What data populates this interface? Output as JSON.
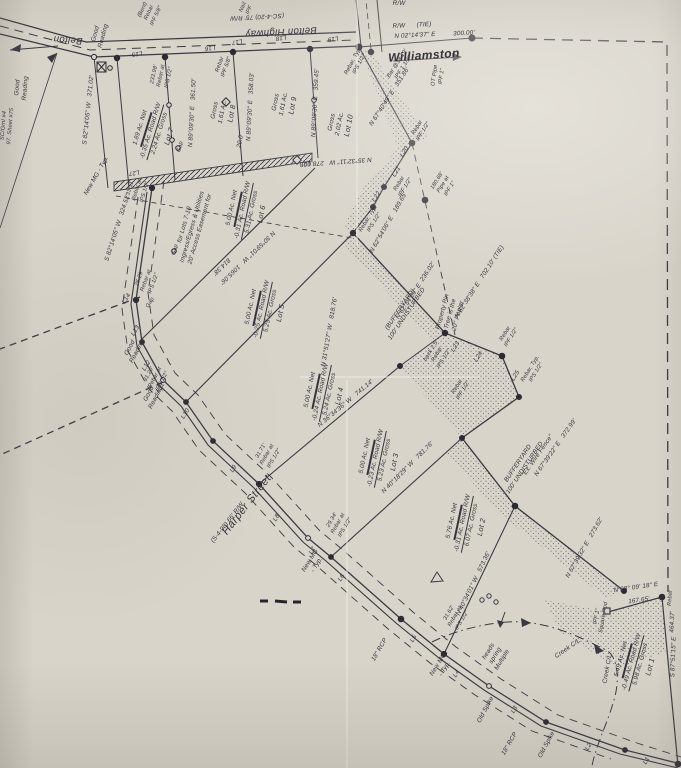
{
  "roads": {
    "belton": "Belton",
    "belton_highway": "Belton Highway",
    "belton_rw": "(SC-4-20) 75' R/W",
    "harper": "Harper Street",
    "harper_rw": "(S-4-98) 66' R/W",
    "williamston": "Williamston",
    "rw_tie": "R/W      (TIE)",
    "rw": "R/W"
  },
  "lots": [
    {
      "name": "Lot 1",
      "gross": "5.98 Ac. Gross",
      "road_rw": "-0.49 Ac. Road R/W",
      "net": "5.49 Ac. Net"
    },
    {
      "name": "Lot 2",
      "gross": "6.07 Ac. Gross",
      "road_rw": "-0.31 Ac. Road R/W",
      "net": "5.76 Ac. Net"
    },
    {
      "name": "Lot 3",
      "gross": "5.23 Ac. Gross",
      "road_rw": "-0.23 Ac. Road R/W",
      "net": "5.00 Ac. Net"
    },
    {
      "name": "Lot 4",
      "gross": "5.24 Ac. Gross",
      "road_rw": "-0.24 Ac. Road R/W",
      "net": "5.00 Ac. Net"
    },
    {
      "name": "Lot 5",
      "gross": "5.25 Ac. Gross",
      "road_rw": "-0.25 Ac. Road R/W",
      "net": "5.00 Ac. Net"
    },
    {
      "name": "Lot 6",
      "gross": "5.31 Ac. Gross",
      "road_rw": "-0.31 Ac. Road R/W",
      "net": "5.00 Ac. Net"
    },
    {
      "name": "Lot 7",
      "gross": "2.24 Ac. Gross",
      "road_rw": "-0.35 Ac. Road R/W",
      "net": "1.89 Ac. Net"
    },
    {
      "name": "Lot 8",
      "gross": "1.61 Ac.",
      "gross2": "Gross"
    },
    {
      "name": "Lot 9",
      "gross": "1.61 Ac.",
      "gross2": "Gross"
    },
    {
      "name": "Lot 10",
      "gross": "2.02 Ac.",
      "gross2": "Gross"
    }
  ],
  "bearings": {
    "tie_belton": "N 02°14'37\" E",
    "tie_belton_dist": "300.00'",
    "lot7_west": "S 82°14'05\" W   371.02'",
    "harper_upper": "S 82°14'05\" W   324.52'",
    "lot78": "N 89°09'30\" E   361.50'",
    "lot89": "N 89°09'30\" E   358.03'",
    "lot910": "N 89°09'30\" E   359.45'",
    "lot10_rear": "N 35°32'11\" W   278.00'",
    "lot10_east": "N 67°40'49\" E   351.86'",
    "l22_course": "N 62°54'06\" E   189.65'",
    "tie_702": "N 62°38'38\" E   702.10' (TIE)",
    "buffer_236": "N 62°54'06\" E  236.02'",
    "buffer_372": "N 67°39'22\" E   372.99'",
    "buffer_273": "N 67°39'32\" E   273.62'",
    "lot12": "N 40°34'01\" W   573.36'",
    "lot23": "N 40°18'29\" W   781.76'",
    "lot34": "N 36°34'36\" W   741.14'",
    "lot45": "N 31°51'27\" W   818.76'",
    "lot56": "N 30°59'01\" W   1065.06'",
    "lot56_dist": "814.38'",
    "se_short": "N 08° 09' 18\" E",
    "se_short_dist": "167.65'",
    "se_long": "S 87°51'15\" E",
    "se_long_dist": "464.37'"
  },
  "segments": {
    "L1": "L1",
    "L2": "L2",
    "L3": "L3",
    "L4": "L4",
    "L5": "L5",
    "L6": "L6",
    "L7": "L7",
    "L8": "L8",
    "L9": "L9",
    "L10": "L10",
    "L11": "L11",
    "L12": "L12",
    "L13": "L13",
    "L14": "L14",
    "L15": "L15",
    "L16": "L16",
    "L17": "L17",
    "L18": "L18",
    "L19": "L19",
    "L20": "L20",
    "L21": "L21",
    "L22": "L22",
    "L23": "L23",
    "L24": "L24",
    "L25": "L25",
    "L27": "L27",
    "L28": "L28"
  },
  "monuments": {
    "ipf58_bent": [
      "IPF 5/8\"",
      "Rebar",
      "(Bent)"
    ],
    "ipf_nail": [
      "IPF",
      "Nail"
    ],
    "ipf58": [
      "IPF 5/8\"",
      "Rebar"
    ],
    "ips_233": [
      "IPS 1/2\"",
      "Rebar at",
      "233.98'"
    ],
    "ips_typ": [
      "IPS 1/2\"",
      "Rebar, Typ."
    ],
    "ipf112_bar": [
      "IPF 1 1/2\"",
      "Bar @38.19'"
    ],
    "ipf1_ot": [
      "IPF 1\"",
      "OT Pipe"
    ],
    "ipf12": [
      "IPF 1/2\"",
      "Rebar"
    ],
    "ipf1_pipe": [
      "IPF 1\"",
      "Pipe at",
      "180.68'"
    ],
    "ips_back": [
      "IPS 1/2\"",
      "Rebar",
      "back 2.5'"
    ],
    "ips_3311": [
      "IPS 1/2\"",
      "Rebar at",
      "33.11'"
    ],
    "ips_2629": [
      "IPS 1/2\"",
      "Rebar at",
      "26.29'"
    ],
    "ips_3120": [
      "IPS 1/2\"",
      "Rebar at",
      "31.20'"
    ],
    "ips_3171": [
      "IPS 1/2\"",
      "Rebar at",
      "31.71'"
    ],
    "ips_2934": [
      "IPS 1/2\"",
      "Rebar at",
      "29.34'"
    ],
    "ips_3162": [
      "IPS 1/2\"",
      "Rebar at",
      "31.62'"
    ],
    "ipf1_sqrod": [
      "IPF 1\"",
      "Square Rod"
    ],
    "rebar": "Rebar"
  },
  "notes": {
    "easement": [
      "20' Access Easement for",
      "Ingress/Egress & Utilities",
      "for Lots 7-10"
    ],
    "poplar": [
      "20\" Poplar",
      "Tree is the",
      "Property Pin"
    ],
    "buffer1": [
      "100' UNDISTURBED",
      "(BUFFERYARD)"
    ],
    "buffer2": [
      "100' UNDISTURBED",
      "BUFFERYARD"
    ],
    "springs": [
      "Multiple",
      "spring",
      "heads"
    ],
    "wire_fence": "\"Ex. Wire Fence\"",
    "creek_cl": "Creek C/L",
    "good_reading": [
      "Good",
      "Reading"
    ],
    "new_mg": [
      "New MG",
      "- Typ."
    ],
    "new_mg_single": "New MG - Typ.",
    "old_spike": "Old Spike",
    "rcp": "18\" RCP",
    "gap": "Gap",
    "sheet_note": [
      "SC/Grnl #4",
      "97. Sheet #75"
    ],
    "lot8_depth": "20.0'"
  }
}
